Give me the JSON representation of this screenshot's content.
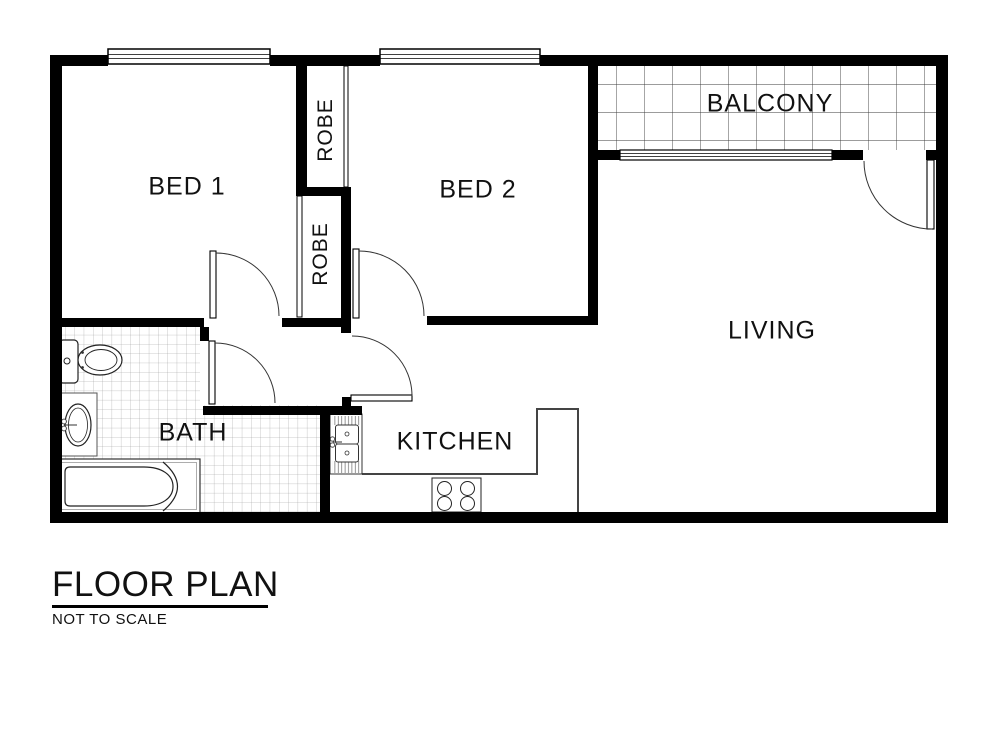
{
  "title": {
    "heading": "FLOOR PLAN",
    "subtitle": "NOT TO SCALE"
  },
  "rooms": [
    {
      "id": "bed1",
      "label": "BED 1"
    },
    {
      "id": "bed2",
      "label": "BED 2"
    },
    {
      "id": "balcony",
      "label": "BALCONY"
    },
    {
      "id": "living",
      "label": "LIVING"
    },
    {
      "id": "bath",
      "label": "BATH"
    },
    {
      "id": "kitchen",
      "label": "KITCHEN"
    },
    {
      "id": "robe_upper",
      "label": "ROBE"
    },
    {
      "id": "robe_lower",
      "label": "ROBE"
    }
  ],
  "fixtures": [
    "toilet-icon",
    "vanity-basin-icon",
    "bathtub-icon",
    "kitchen-sink-icon",
    "cooktop-icon"
  ],
  "features": [
    "window-bed1",
    "window-bed2",
    "balcony-sliding-window",
    "door-bed1",
    "door-bed2",
    "door-bath",
    "door-kitchen",
    "door-balcony",
    "robe-upper-open-front",
    "robe-lower-open-front"
  ],
  "colors": {
    "wall": "#000000",
    "thin_line": "#222222",
    "counter_line": "#444444",
    "tile_line_large": "#3a3a3a",
    "tile_line_small": "#9a9a9a",
    "background": "#ffffff"
  }
}
